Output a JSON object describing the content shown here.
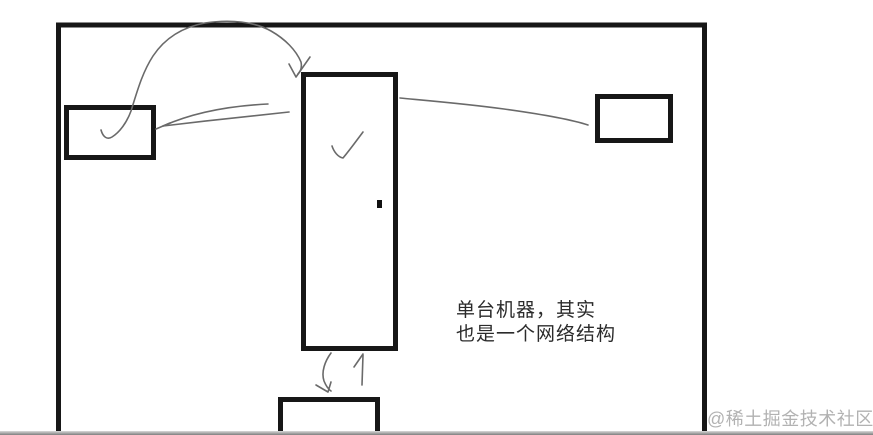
{
  "canvas": {
    "width": 873,
    "height": 435
  },
  "colors": {
    "background": "#ffffff",
    "box_stroke": "#171717",
    "sketch_stroke": "#6a6a6a",
    "annotation_text": "#2b2b2b",
    "watermark_text": "#b2b2b2",
    "bottom_bar": "#7e7e7e"
  },
  "diagram": {
    "frame": {
      "name": "network-boundary-frame"
    },
    "nodes": {
      "left_box": {
        "name": "left-node-box",
        "icon": "checkmark-icon"
      },
      "center_box": {
        "name": "center-tall-node-box",
        "icon": "checkmark-icon",
        "marker": "small-black-dot"
      },
      "right_box": {
        "name": "right-node-box"
      },
      "bottom_box": {
        "name": "bottom-node-box"
      }
    },
    "connectors": [
      {
        "name": "curved-arrow-left-to-center-top",
        "from": "left_box",
        "to": "center_box"
      },
      {
        "name": "double-stroke-arrow-center-to-left",
        "from": "center_box",
        "to": "left_box"
      },
      {
        "name": "line-center-to-right",
        "from": "center_box",
        "to": "right_box"
      },
      {
        "name": "down-arrow-center-to-bottom",
        "from": "center_box",
        "to": "bottom_box"
      },
      {
        "name": "up-arrow-bottom-to-center",
        "from": "bottom_box",
        "to": "center_box"
      }
    ]
  },
  "annotation": {
    "line1": "单台机器，其实",
    "line2": "也是一个网络结构"
  },
  "watermark": {
    "text": "@稀土掘金技术社区"
  }
}
